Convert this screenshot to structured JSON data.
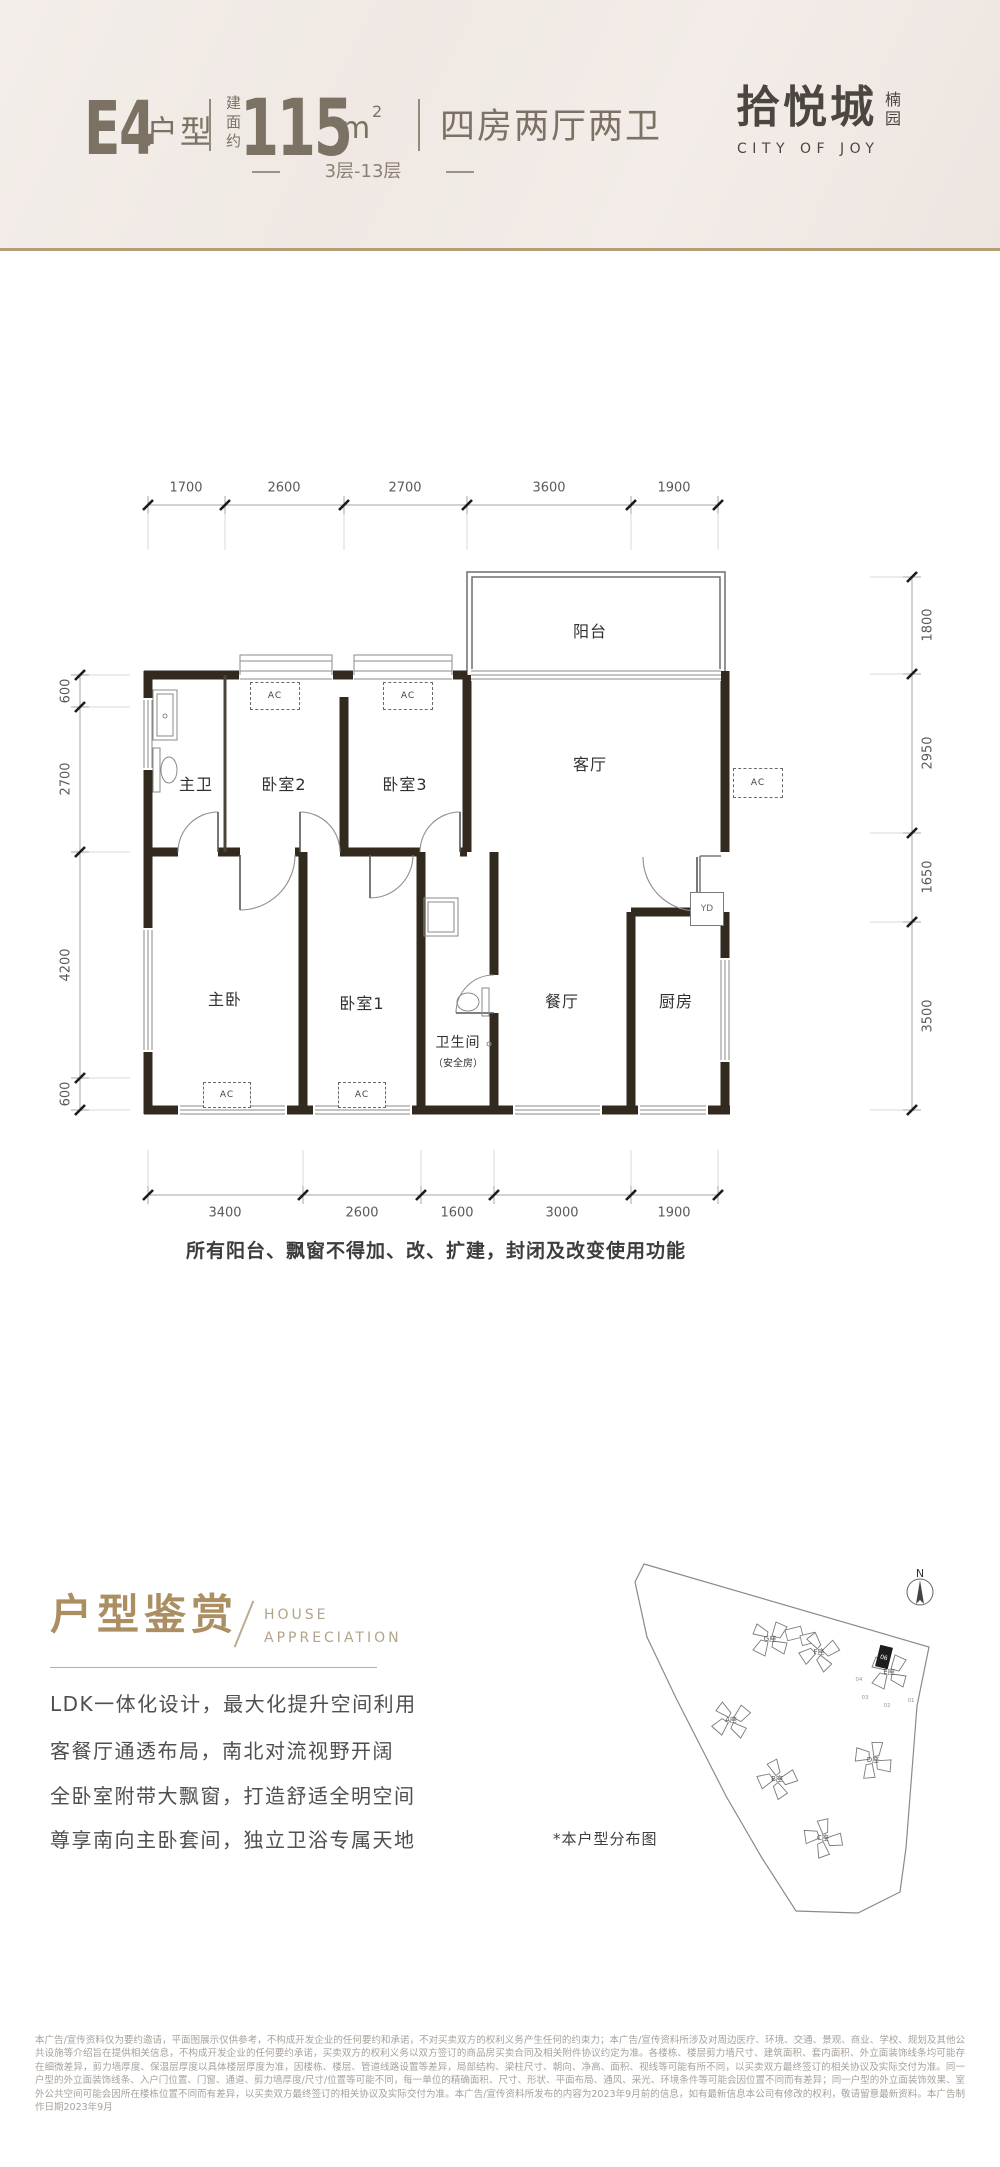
{
  "theme": {
    "gold_rule": "#b49e76",
    "title_gold": "#ab8f63",
    "header_text": "#7b7264",
    "wall_color": "#32291f",
    "hero_bg": "#f2ebe7"
  },
  "header": {
    "unit": "E4",
    "unit_suffix": "户型",
    "area_prefix": [
      "建",
      "面",
      "约"
    ],
    "area_value": "115",
    "area_unit": "m",
    "area_sup": "2",
    "rooms_desc": "四房两厅两卫",
    "floors": "3层-13层",
    "logo": {
      "name": "拾悦城",
      "sub": [
        "楠",
        "园"
      ],
      "en": "CITY OF JOY"
    }
  },
  "plan": {
    "dims_top": [
      "1700",
      "2600",
      "2700",
      "3600",
      "1900"
    ],
    "dims_bottom": [
      "3400",
      "2600",
      "1600",
      "3000",
      "1900"
    ],
    "dims_left": [
      "600",
      "2700",
      "4200",
      "600"
    ],
    "dims_right": [
      "1800",
      "2950",
      "1650",
      "3500"
    ],
    "rooms": {
      "balcony": "阳台",
      "master_bath": "主卫",
      "bedroom2": "卧室2",
      "bedroom3": "卧室3",
      "living": "客厅",
      "master_bedroom": "主卧",
      "bedroom1": "卧室1",
      "bathroom": "卫生间",
      "bathroom_sub": "（安全房）",
      "dining": "餐厅",
      "kitchen": "厨房"
    },
    "ac_label": "AC",
    "yd_label": "YD",
    "note": "所有阳台、飘窗不得加、改、扩建，封闭及改变使用功能"
  },
  "appreciation": {
    "title": "户型鉴赏",
    "subtitle_line1": "HOUSE",
    "subtitle_line2": "APPRECIATION",
    "lines": [
      "LDK一体化设计，最大化提升空间利用",
      "客餐厅通透布局，南北对流视野开阔",
      "全卧室附带大飘窗，打造舒适全明空间",
      "尊享南向主卧套间，独立卫浴专属天地"
    ]
  },
  "siteplan": {
    "north_label": "N",
    "caption": "*本户型分布图",
    "buildings": [
      "G座",
      "F座",
      "E座",
      "A座",
      "B座",
      "D座",
      "C座"
    ],
    "units": [
      "04",
      "03",
      "02",
      "01"
    ],
    "highlight_unit": "06"
  },
  "disclaimer": "本广告/宣传资料仅为要约邀请，平面图展示仅供参考，不构成开发企业的任何要约和承诺，不对买卖双方的权利义务产生任何的约束力；本广告/宣传资料所涉及对周边医疗、环境、交通、景观、商业、学校、规划及其他公共设施等介绍旨在提供相关信息，不构成开发企业的任何要约承诺，买卖双方的权利义务以双方签订的商品房买卖合同及相关附件协议约定为准。各楼栋、楼层剪力墙尺寸、建筑面积、套内面积、外立面装饰线条均可能存在细微差异，剪力墙厚度、保温层厚度以具体楼层厚度为准，因楼栋、楼层、管道线路设置等差异，局部结构、梁柱尺寸、朝向、净高、面积、视线等可能有所不同，以买卖双方最终签订的相关协议及实际交付为准。同一户型的外立面装饰线条、入户门位置、门窗、通道、剪力墙厚度/尺寸/位置等可能不同，每一单位的精确面积、尺寸、形状、平面布局、通风、采光、环境条件等可能会因位置不同而有差异；同一户型的外立面装饰效果、室外公共空间可能会因所在楼栋位置不同而有差异，以买卖双方最终签订的相关协议及实际交付为准。本广告/宣传资料所发布的内容为2023年9月前的信息，如有最新信息本公司有修改的权利，敬请留意最新资料。本广告制作日期2023年9月"
}
